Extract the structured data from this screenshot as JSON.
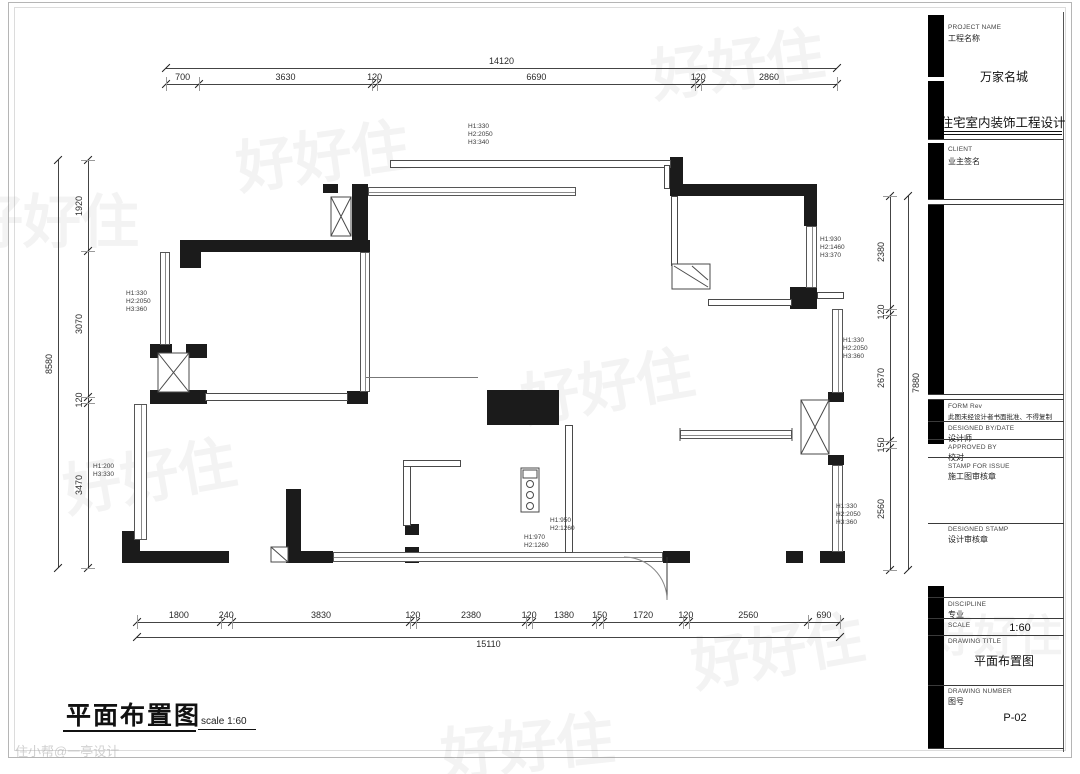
{
  "title_block": {
    "project_name_label": "PROJECT NAME",
    "project_name_cn": "工程名称",
    "project_name": "万家名城",
    "project_type": "住宅室内装饰工程设计",
    "client_label": "CLIENT",
    "client_value": "业主签名",
    "form_label": "FORM Rev",
    "form_note": "此图未经设计者书面批准、不得复制",
    "designed_by_label": "DESIGNED BY/DATE",
    "designed_by_value": "设计师",
    "approved_by_label": "APPROVED BY",
    "approved_by_value": "校对",
    "stamp_for_issue_label": "STAMP FOR ISSUE",
    "stamp_for_issue_value": "施工图审核章",
    "designed_stamp_label": "DESIGNED STAMP",
    "designed_stamp_value": "设计审核章",
    "discipline_label": "DISCIPLINE",
    "discipline_value": "专业",
    "scale_label": "SCALE",
    "scale_value": "1:60",
    "drawing_title_label": "DRAWING TITLE",
    "drawing_title": "平面布置图",
    "drawing_number_label": "DRAWING NUMBER",
    "drawing_number_cn": "图号",
    "drawing_number": "P-02"
  },
  "plan_title": {
    "text": "平面布置图",
    "scale_note": "scale 1:60"
  },
  "dimensions": {
    "top": {
      "overall": "14120",
      "segments": [
        "700",
        "3630",
        "120",
        "6690",
        "120",
        "2860"
      ]
    },
    "bottom": {
      "overall": "15110",
      "segments": [
        "1800",
        "240",
        "3830",
        "120",
        "2380",
        "120",
        "1380",
        "150",
        "1720",
        "120",
        "2560",
        "690"
      ]
    },
    "left": {
      "overall": "8580",
      "segments": [
        "1920",
        "3070",
        "120",
        "3470"
      ]
    },
    "right": {
      "overall": "7880",
      "segments": [
        "2380",
        "120",
        "2670",
        "150",
        "2560"
      ]
    }
  },
  "annotations": {
    "a1": "H1:330\nH2:2050\nH3:340",
    "a2": "H1:330\nH2:2050\nH3:360",
    "a3": "H1:200\nH3:330",
    "a4": "H1:930\nH2:1460\nH3:370",
    "a5": "H1:330\nH2:2050\nH3:360",
    "a6": "H1:330\nH2:2050\nH3:360",
    "a7": "H1:950\nH2:1260",
    "a8": "H1:970\nH2:1260"
  },
  "watermark": {
    "text": "好好住",
    "credit": "住小帮@一亭设计"
  }
}
